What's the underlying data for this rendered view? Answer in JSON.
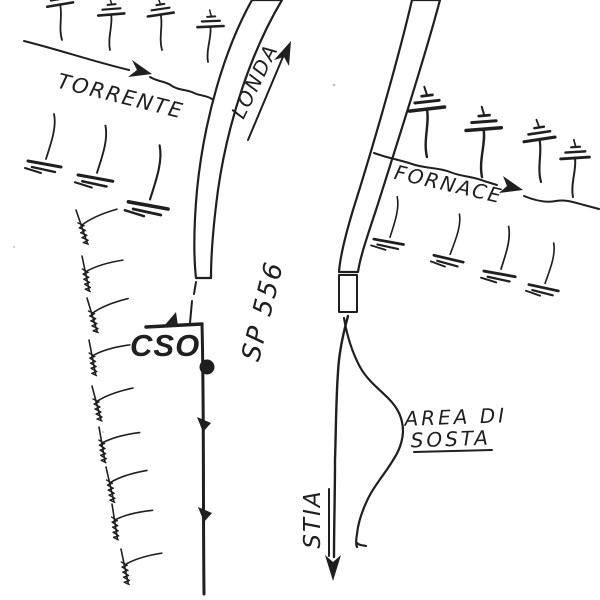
{
  "map": {
    "background": "#ffffff",
    "ink": "#1f1f1f",
    "labels": {
      "torrente": "TORRENTE",
      "londa": "LONDA",
      "road": "SP 556",
      "cso": "CSO",
      "fornace": "FORNACE",
      "area_line1": "AREA DI",
      "area_line2": "SOSTA",
      "stia": "STIA"
    },
    "arrows": [
      {
        "name": "torrente-flow-arrow",
        "direction": "east"
      },
      {
        "name": "londa-direction-arrow",
        "direction": "north"
      },
      {
        "name": "fornace-flow-arrow",
        "direction": "east"
      },
      {
        "name": "stia-direction-arrow",
        "direction": "south"
      }
    ],
    "icons": {
      "tree": "tree-icon",
      "scrub": "scrub-icon",
      "arrowhead": "flow-arrow-icon",
      "dot_marker": "dot-marker-icon",
      "triangle_marker": "triangle-marker-icon",
      "road_hatching": "hatched-road-band"
    }
  }
}
